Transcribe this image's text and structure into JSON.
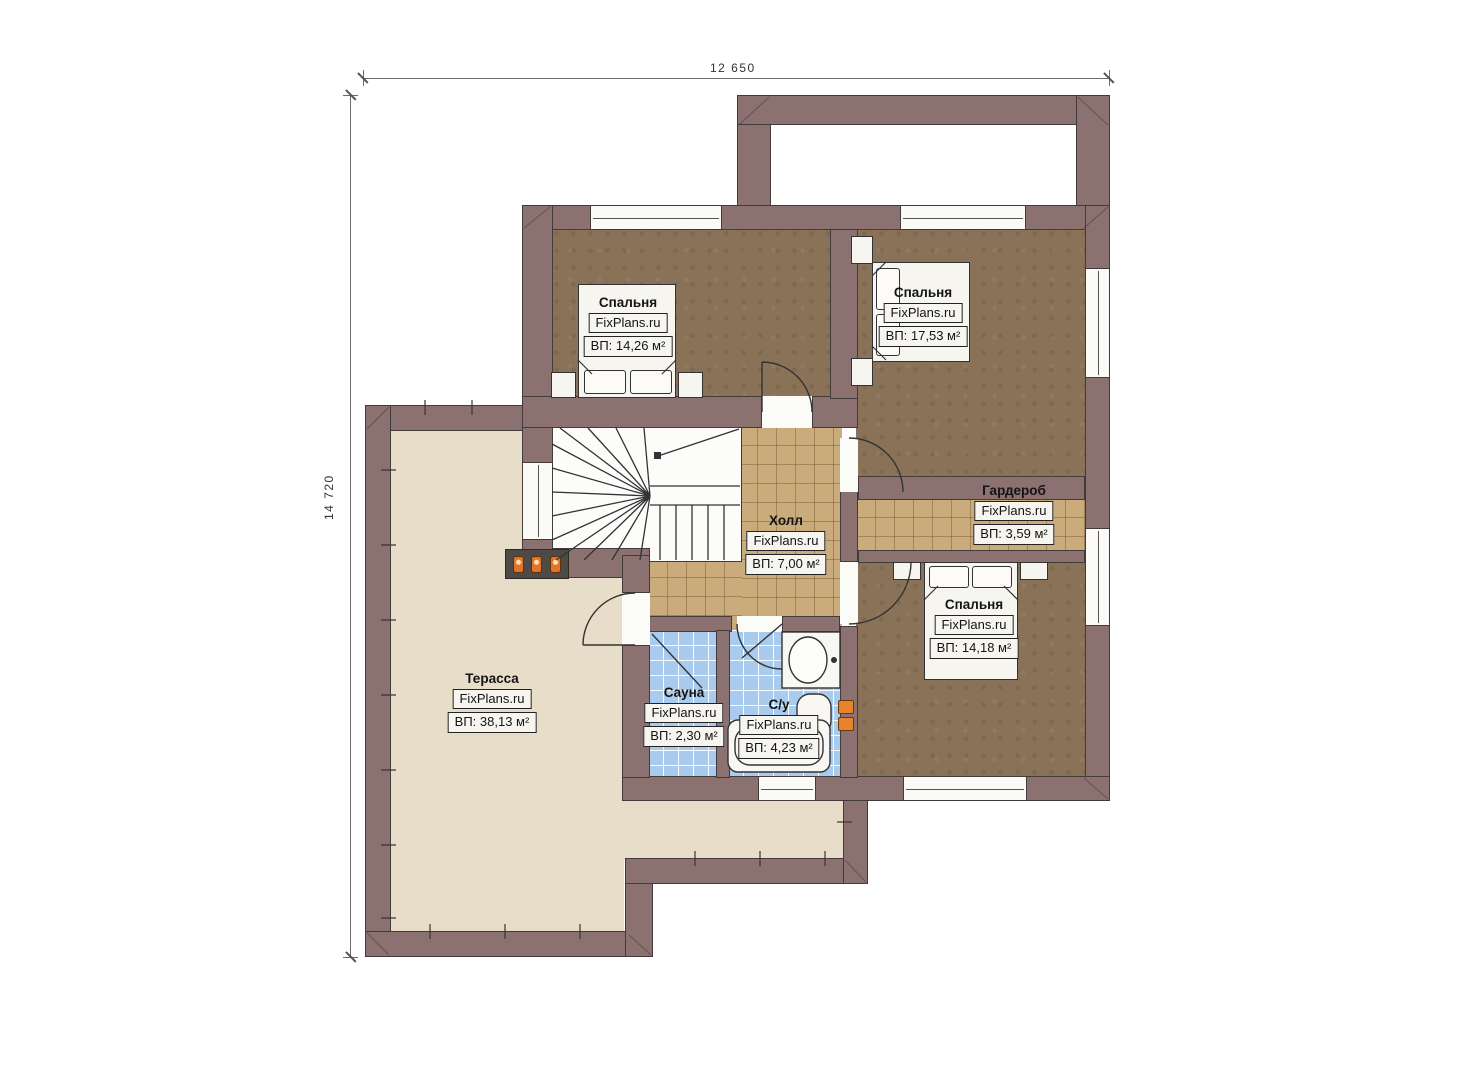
{
  "dimensions": {
    "top": "12 650",
    "left": "14 720"
  },
  "rooms": [
    {
      "key": "bedroom-top-left",
      "name": "Спальня",
      "brand": "FixPlans.ru",
      "area": "ВП: 14,26 м²"
    },
    {
      "key": "bedroom-top-right",
      "name": "Спальня",
      "brand": "FixPlans.ru",
      "area": "ВП: 17,53 м²"
    },
    {
      "key": "wardrobe",
      "name": "Гардероб",
      "brand": "FixPlans.ru",
      "area": "ВП: 3,59 м²"
    },
    {
      "key": "hall",
      "name": "Холл",
      "brand": "FixPlans.ru",
      "area": "ВП: 7,00 м²"
    },
    {
      "key": "bedroom-bottom-right",
      "name": "Спальня",
      "brand": "FixPlans.ru",
      "area": "ВП: 14,18 м²"
    },
    {
      "key": "terrace",
      "name": "Терасса",
      "brand": "FixPlans.ru",
      "area": "ВП: 38,13 м²"
    },
    {
      "key": "sauna",
      "name": "Сауна",
      "brand": "FixPlans.ru",
      "area": "ВП: 2,30 м²"
    },
    {
      "key": "bathroom",
      "name": "С/у",
      "brand": "FixPlans.ru",
      "area": "ВП: 4,23 м²"
    }
  ],
  "colors": {
    "wall": "#8c7171",
    "carpet_floor": "#8a7258",
    "tan_tile_floor": "#c9ab7c",
    "blue_tile_floor": "#a9cbee",
    "terrace_floor": "#e8ddc8",
    "accent_orange": "#e0742c"
  }
}
